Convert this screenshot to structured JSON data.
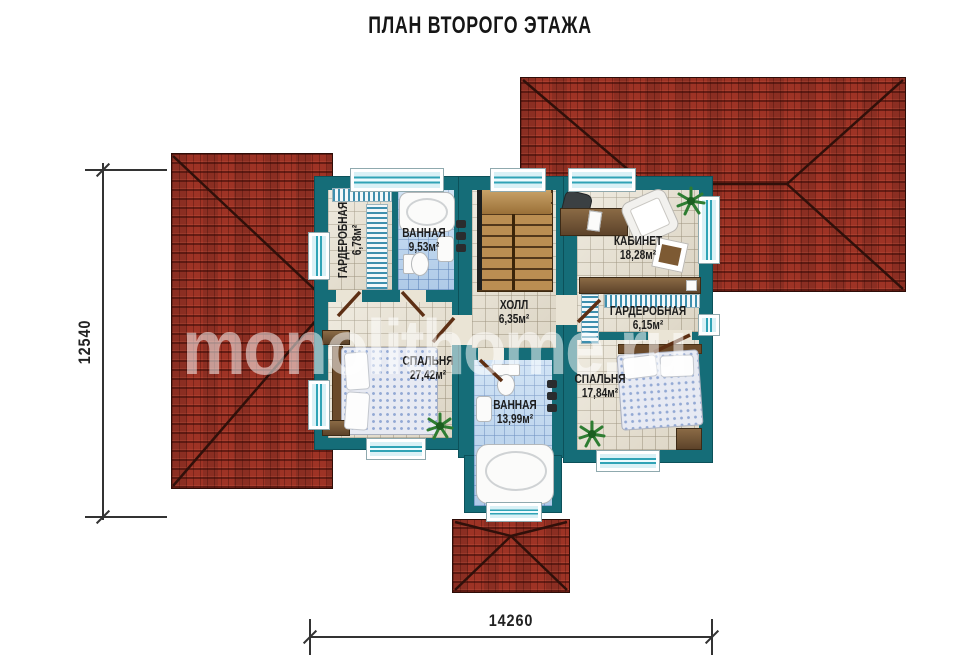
{
  "title": "ПЛАН ВТОРОГО ЭТАЖА",
  "watermark": "monolithome.ru",
  "dimensions": {
    "vertical": "12540",
    "horizontal": "14260"
  },
  "rooms": [
    {
      "name": "ГАРДЕРОБНАЯ",
      "area": "6,78м²"
    },
    {
      "name": "ВАННАЯ",
      "area": "9,53м²"
    },
    {
      "name": "ХОЛЛ",
      "area": "6,35м²"
    },
    {
      "name": "КАБИНЕТ",
      "area": "18,28м²"
    },
    {
      "name": "ГАРДЕРОБНАЯ",
      "area": "6,15м²"
    },
    {
      "name": "СПАЛЬНЯ",
      "area": "27,42м²"
    },
    {
      "name": "ВАННАЯ",
      "area": "13,99м²"
    },
    {
      "name": "СПАЛЬНЯ",
      "area": "17,84м²"
    }
  ],
  "colors": {
    "wall": "#156d78",
    "roof": "#a33628",
    "floor": "#eae4d5",
    "bath_tile": "#bdd7f0",
    "wood": "#b3854a",
    "dimension_line": "#333333"
  }
}
